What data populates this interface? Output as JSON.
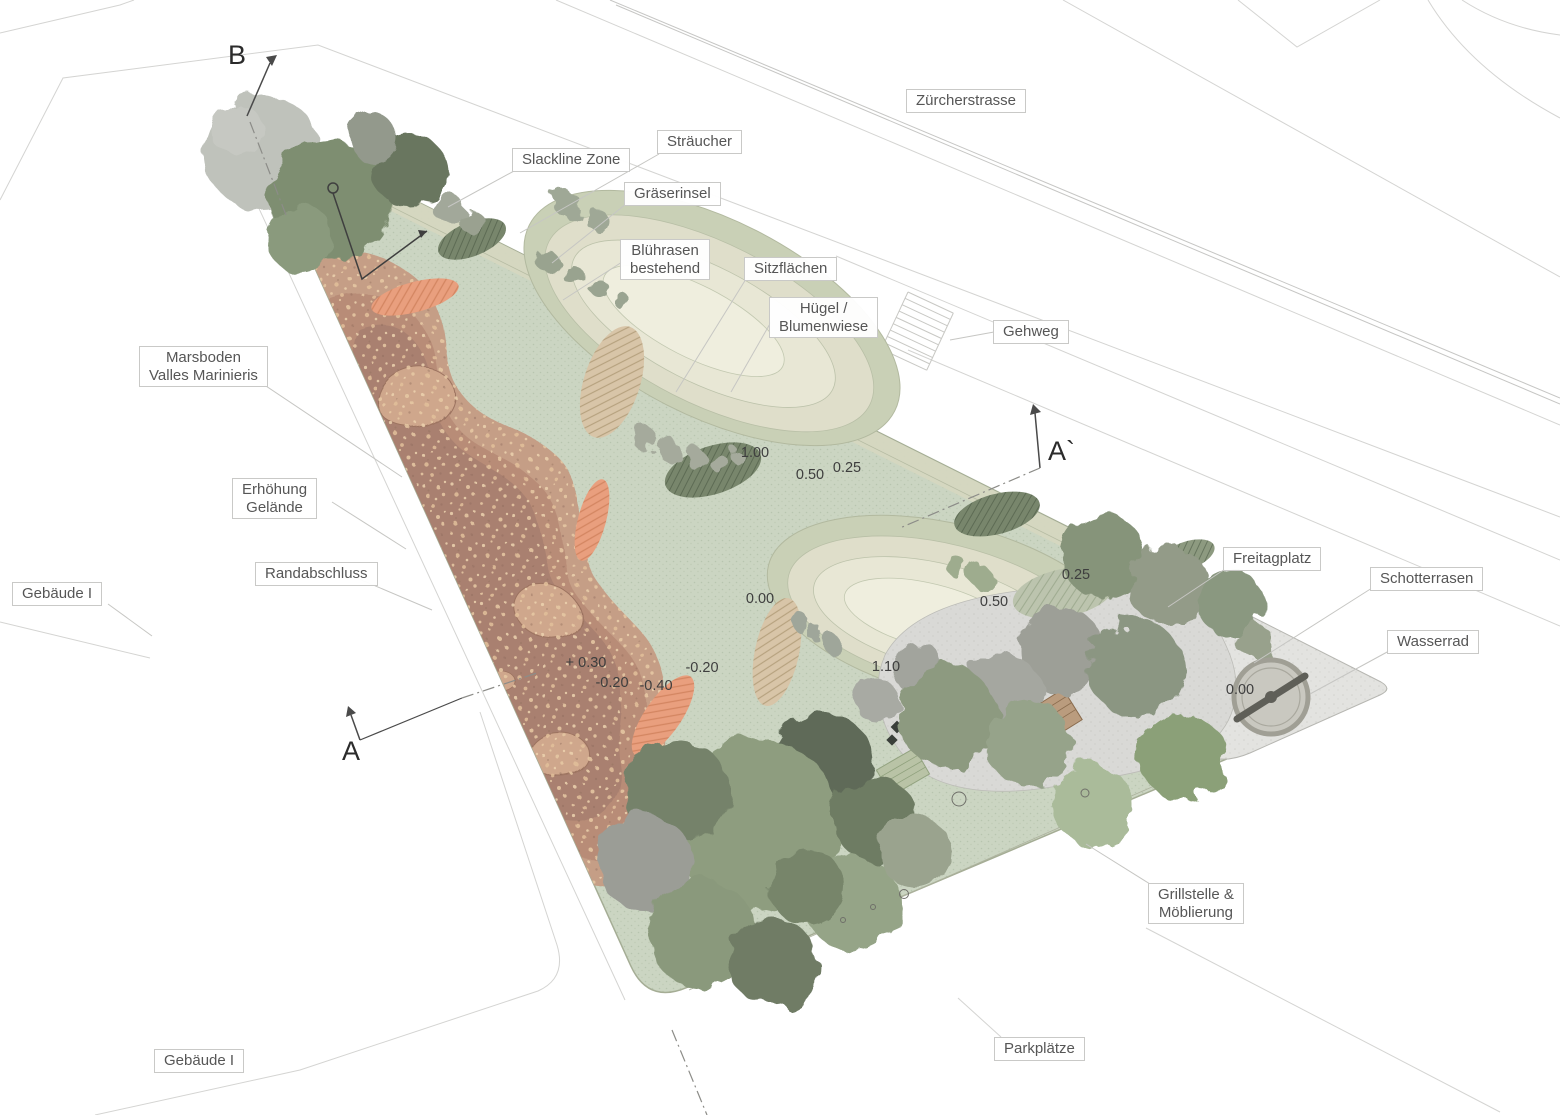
{
  "plan": {
    "labels": {
      "zuercherstrasse": "Zürcherstrasse",
      "straeucher": "Sträucher",
      "slackline_zone": "Slackline Zone",
      "graeserinsel": "Gräserinsel",
      "bluehrasen": [
        "Blührasen",
        "bestehend"
      ],
      "sitzflaechen": "Sitzflächen",
      "huegel": [
        "Hügel /",
        "Blumenwiese"
      ],
      "gehweg": "Gehweg",
      "marsboden": [
        "Marsboden",
        "Valles Marinieris"
      ],
      "erhoehung": [
        "Erhöhung",
        "Gelände"
      ],
      "randabschluss": "Randabschluss",
      "gebaeude_left": "Gebäude I",
      "freitagplatz": "Freitagplatz",
      "schotterrasen": "Schotterrasen",
      "wasserrad": "Wasserrad",
      "grillstelle": [
        "Grillstelle &",
        "Möblierung"
      ],
      "parkplaetze": "Parkplätze",
      "gebaeude_bottom": "Gebäude I"
    },
    "sections": {
      "a": "A",
      "a_prime": "A`",
      "b": "B"
    },
    "elevations": [
      "1.00",
      "0.50",
      "0.25",
      "0.00",
      "0.50",
      "0.25",
      "1.10",
      "+ 0.30",
      "-0.20",
      "-0.40",
      "-0.20",
      "0.00"
    ],
    "colors": {
      "site_green": "#cbd5c2",
      "meadow_cream": "#efeede",
      "mars_soil": "#b88c77",
      "accent_orange": "#e99f7e",
      "gravel": "#e3e3e0",
      "tree_dark": "#5f6b58",
      "tree_sage": "#8e9d7f"
    }
  }
}
